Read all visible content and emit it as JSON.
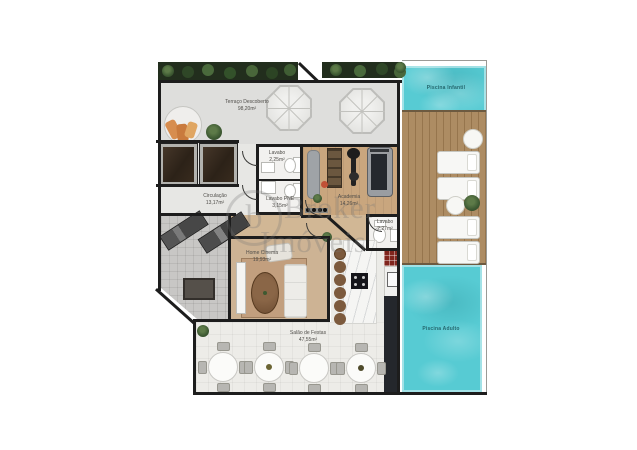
{
  "watermark": {
    "line1": "Broker",
    "line2": "Imóveis",
    "logo_letter": "b"
  },
  "rooms": {
    "terrace": {
      "name": "Terraço Descoberto",
      "area": "98,20m²"
    },
    "circulation": {
      "name": "Circulação",
      "area": "13,17m²"
    },
    "lavabo": {
      "name": "Lavabo",
      "area": "2,25m²"
    },
    "lavabo_pne": {
      "name": "Lavabo PNE",
      "area": "3,15m²"
    },
    "academia": {
      "name": "Academia",
      "area": "14,26m²"
    },
    "lavabo_2": {
      "name": "Lavabo",
      "area": "2,27m²"
    },
    "home_cinema": {
      "name": "Home Cinema",
      "area": "19,93m²"
    },
    "salao_festas": {
      "name": "Salão de Festas",
      "area": "47,55m²"
    },
    "piscina_infantil": {
      "name": "Piscina Infantil"
    },
    "piscina_adulto": {
      "name": "Piscina Adulto"
    }
  },
  "colors": {
    "pool_water": "#57cbd3",
    "deck_wood": "#ab8a62",
    "gym_wood": "#c9a67e",
    "wall": "#1d1d1d",
    "terrace_floor": "#dededc",
    "plant_green": "#3e5a33"
  }
}
